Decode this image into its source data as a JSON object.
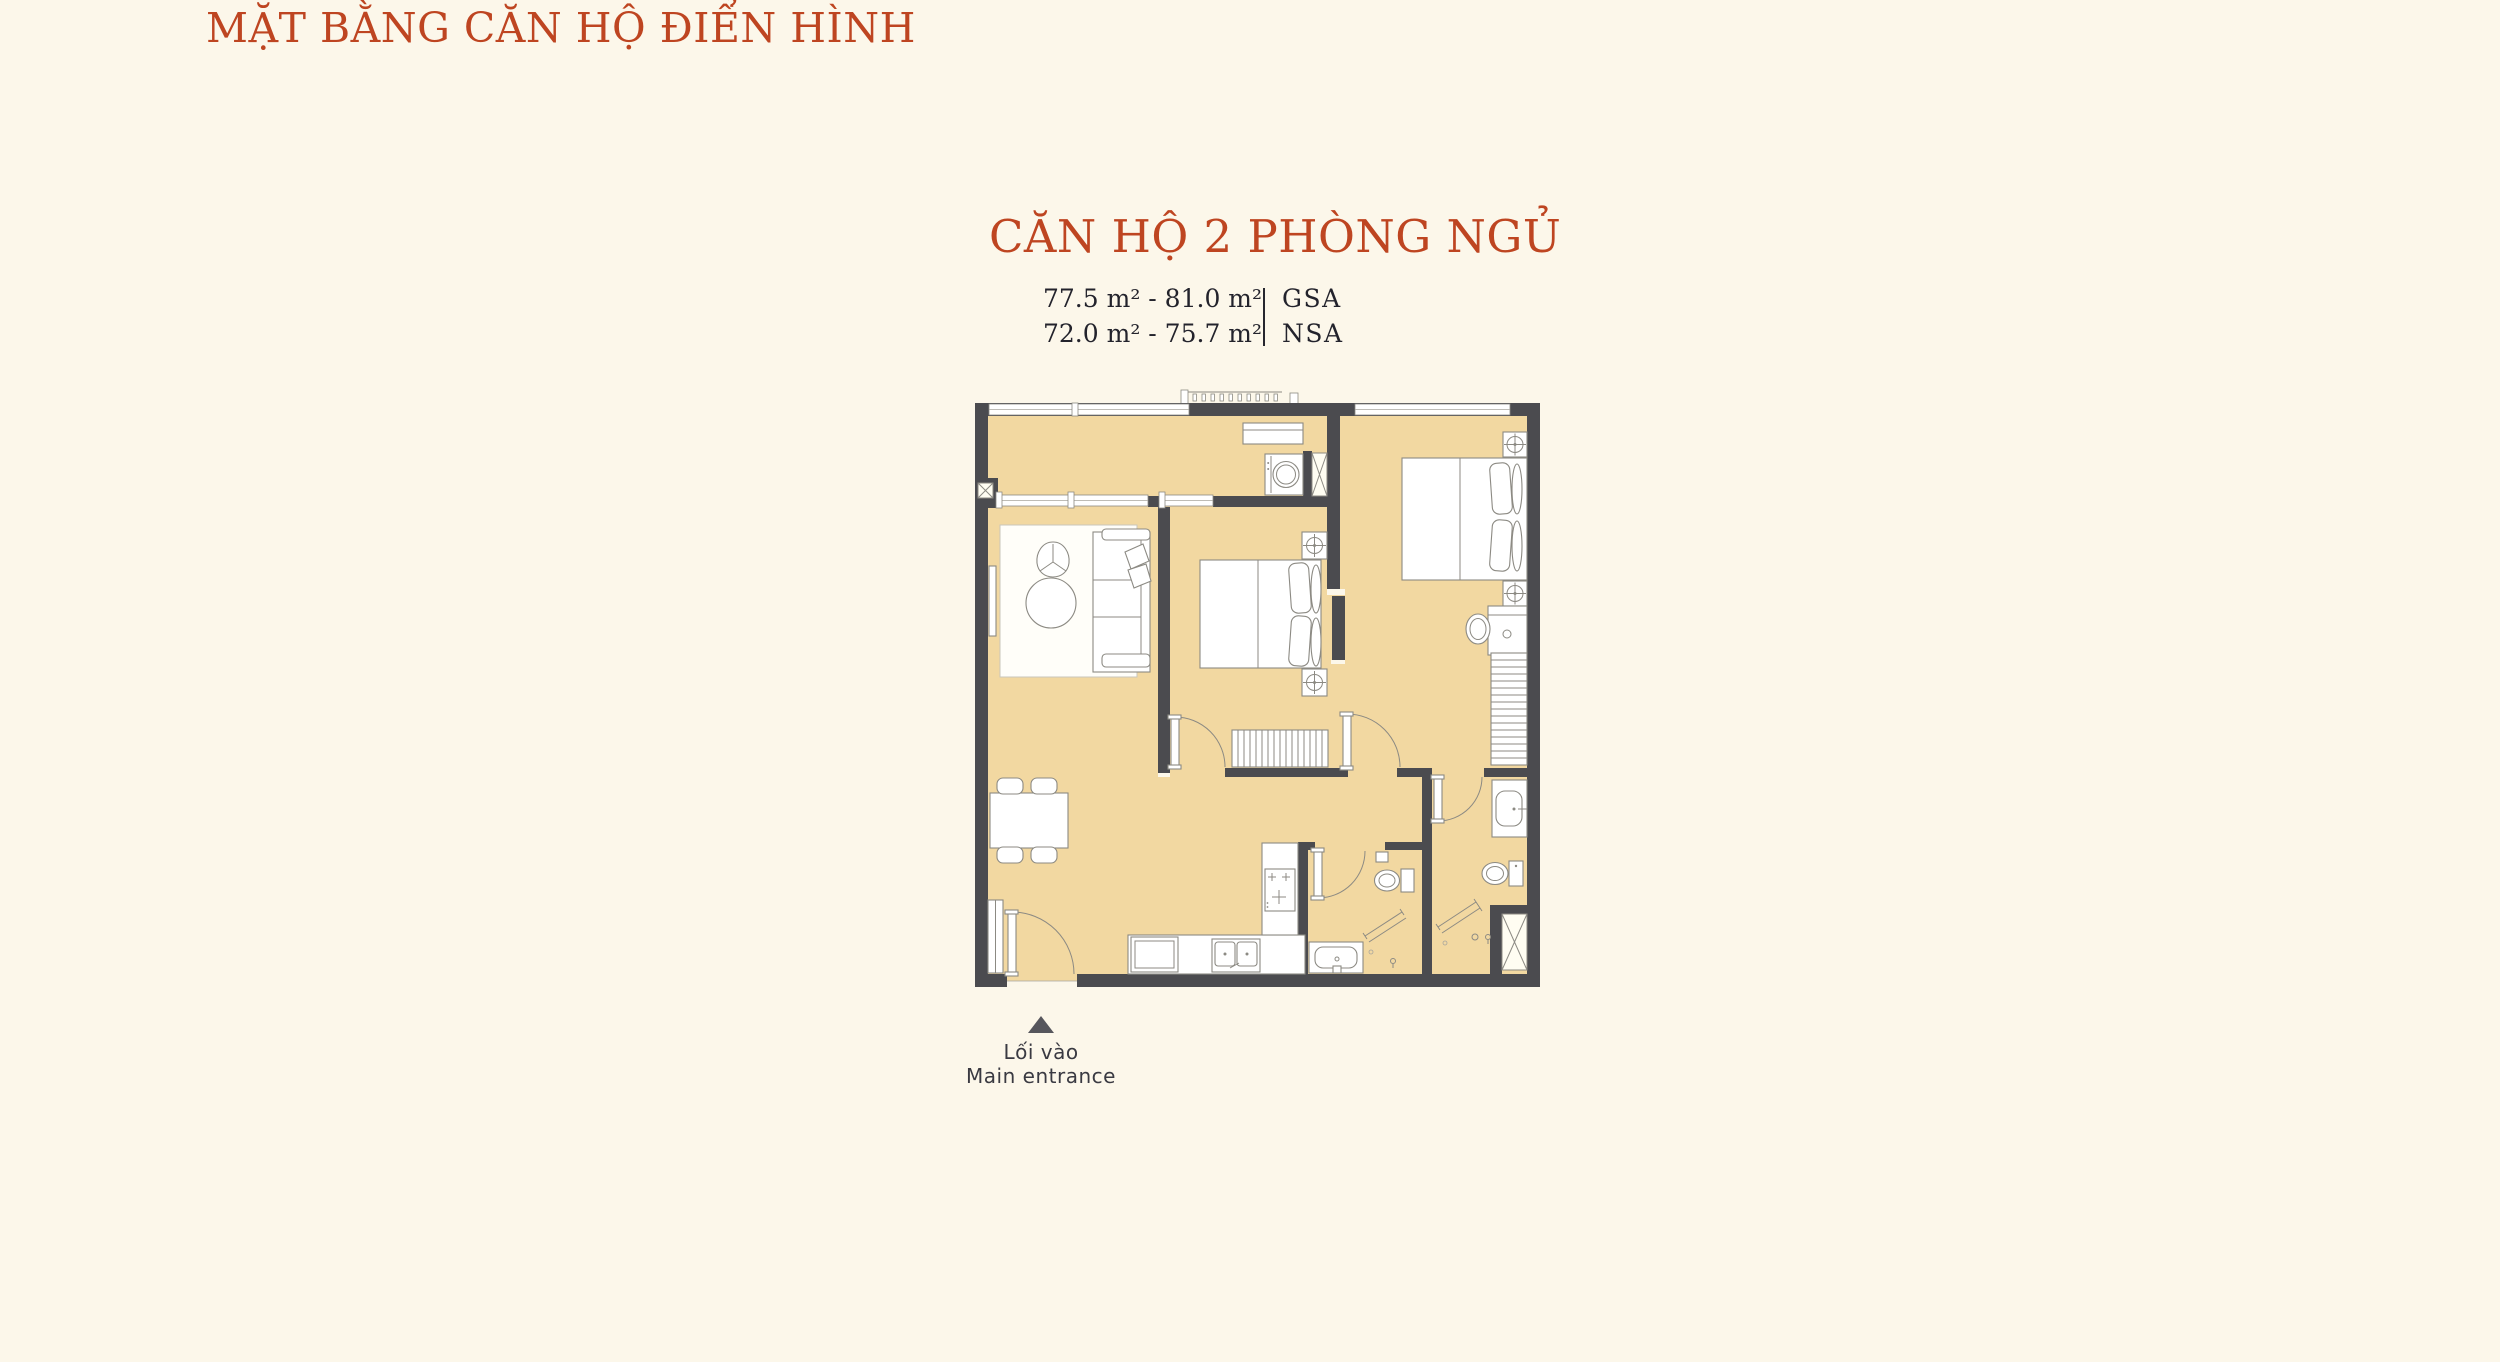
{
  "page": {
    "title": "MẶT BẰNG CĂN HỘ ĐIỂN HÌNH"
  },
  "unit": {
    "name": "CĂN HỘ 2 PHÒNG NGỦ",
    "area_rows": [
      {
        "value": "77.5 m² - 81.0 m²",
        "label": "GSA"
      },
      {
        "value": "72.0 m² - 75.7 m²",
        "label": "NSA"
      }
    ]
  },
  "entrance": {
    "vi": "Lối vào",
    "en": "Main entrance"
  },
  "colors": {
    "accent": "#BE4521",
    "wall": "#4B4B4F",
    "floor": "#F2D8A1",
    "background": "#FCF7EA",
    "text": "#23232C",
    "entrance_text": "#3A3A42",
    "entrance_triangle": "#56565C"
  }
}
